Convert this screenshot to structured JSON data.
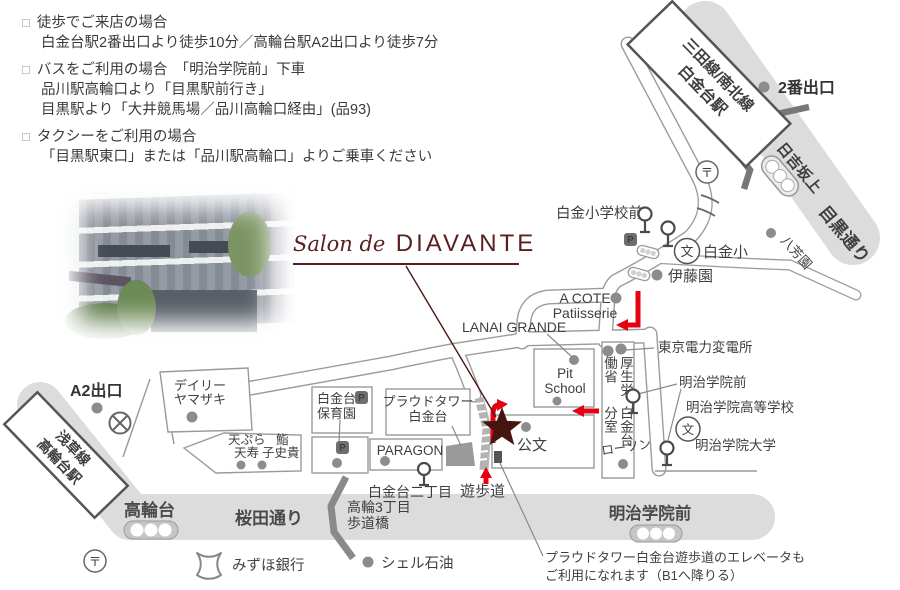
{
  "access": {
    "bullet": "□",
    "items": [
      {
        "title": "徒歩でご来店の場合",
        "lines": [
          "白金台駅2番出口より徒歩10分／高輪台駅A2出口より徒歩7分"
        ]
      },
      {
        "title": "バスをご利用の場合　「明治学院前」下車",
        "lines": [
          "品川駅高輪口より「目黒駅前行き」",
          "目黒駅より「大井競馬場／品川高輪口経由」(品93)"
        ]
      },
      {
        "title": "タクシーをご利用の場合",
        "lines": [
          "「目黒駅東口」または「品川駅高輪口」よりご乗車ください"
        ]
      }
    ]
  },
  "logo": {
    "script": "Salon de",
    "name": "DIAVANTE"
  },
  "map": {
    "stations": {
      "shirokanedai": {
        "line": "三田線/南北線",
        "name": "白金台駅"
      },
      "takanawadai": {
        "line": "浅草線",
        "name": "高輪台駅"
      }
    },
    "exits": {
      "exit2": "2番出口",
      "exitA2": "A2出口"
    },
    "roads": {
      "meguro": "目黒通り",
      "hiyoshizaka": "日吉坂上",
      "sakurada": "桜田通り",
      "takanawadai_stop": "高輪台",
      "meijigakuin_stop": "明治学院前"
    },
    "labels": {
      "shirokane_sho_mae": "白金小学校前",
      "shirokane_sho": "白金小",
      "bunko": "文",
      "post": "〒",
      "parking": "P",
      "itoen": "伊藤園",
      "happoen": "八芳園",
      "acote1": "A COTE",
      "acote2": "Patiisserie",
      "lanai": "LANAI GRANDE",
      "pit1": "Pit",
      "pit2": "School",
      "tepco": "東京電力変電所",
      "mhlw_right": "厚生労働省",
      "mhlw_left": "白金台分室",
      "lawson": "ローソン",
      "meiji_mae": "明治学院前",
      "meiji_hs": "明治学院高等学校",
      "meiji_univ": "明治学院大学",
      "kumon": "公文",
      "proud1": "プラウドタワー",
      "proud2": "白金台",
      "paragon": "PARAGON",
      "hoikuen1": "白金台",
      "hoikuen2": "保育園",
      "daily1": "デイリー",
      "daily2": "ヤマザキ",
      "tempura1": "天ぷら",
      "tempura2": "天寿",
      "sushi1": "鮨",
      "sushi2": "子史貴",
      "nichome": "白金台二丁目",
      "promenade": "遊歩道",
      "hodokyo1": "高輪3丁目",
      "hodokyo2": "歩道橋",
      "mizuho": "みずほ銀行",
      "shell": "シェル石油"
    },
    "note": {
      "line1": "プラウドタワー白金台遊歩道のエレベータも",
      "line2": "ご利用になれます（B1へ降りる）"
    },
    "colors": {
      "accent_red": "#e60012",
      "brand_maroon": "#4a1a12",
      "road_gray": "#dcdcdc",
      "line_gray": "#999999",
      "dark_gray": "#777777"
    }
  }
}
